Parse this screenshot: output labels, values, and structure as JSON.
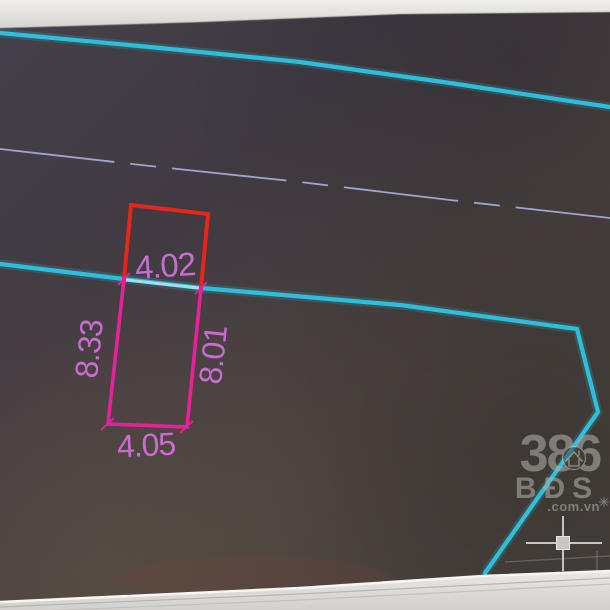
{
  "plot": {
    "dimension_labels": {
      "top": "4.02",
      "left": "8.33",
      "right": "8.01",
      "bottom": "4.05"
    }
  },
  "watermark": {
    "number": "386",
    "letters": "BĐS",
    "domain": ".com.vn"
  },
  "cursor": {
    "type": "crosshair-with-pickbox"
  },
  "colors": {
    "boundary_cyan": "#2cc3de",
    "centerline_lavender": "#a8aad8",
    "outline_red": "#e6251c",
    "outline_pink": "#e8219a",
    "dimension_text": "#cf6fd8",
    "watermark_gray": "#b5b2ac",
    "cursor_gray": "#dbdbd9",
    "bezel_light": "#e7e5e1",
    "screen_dark": "#443d43"
  }
}
